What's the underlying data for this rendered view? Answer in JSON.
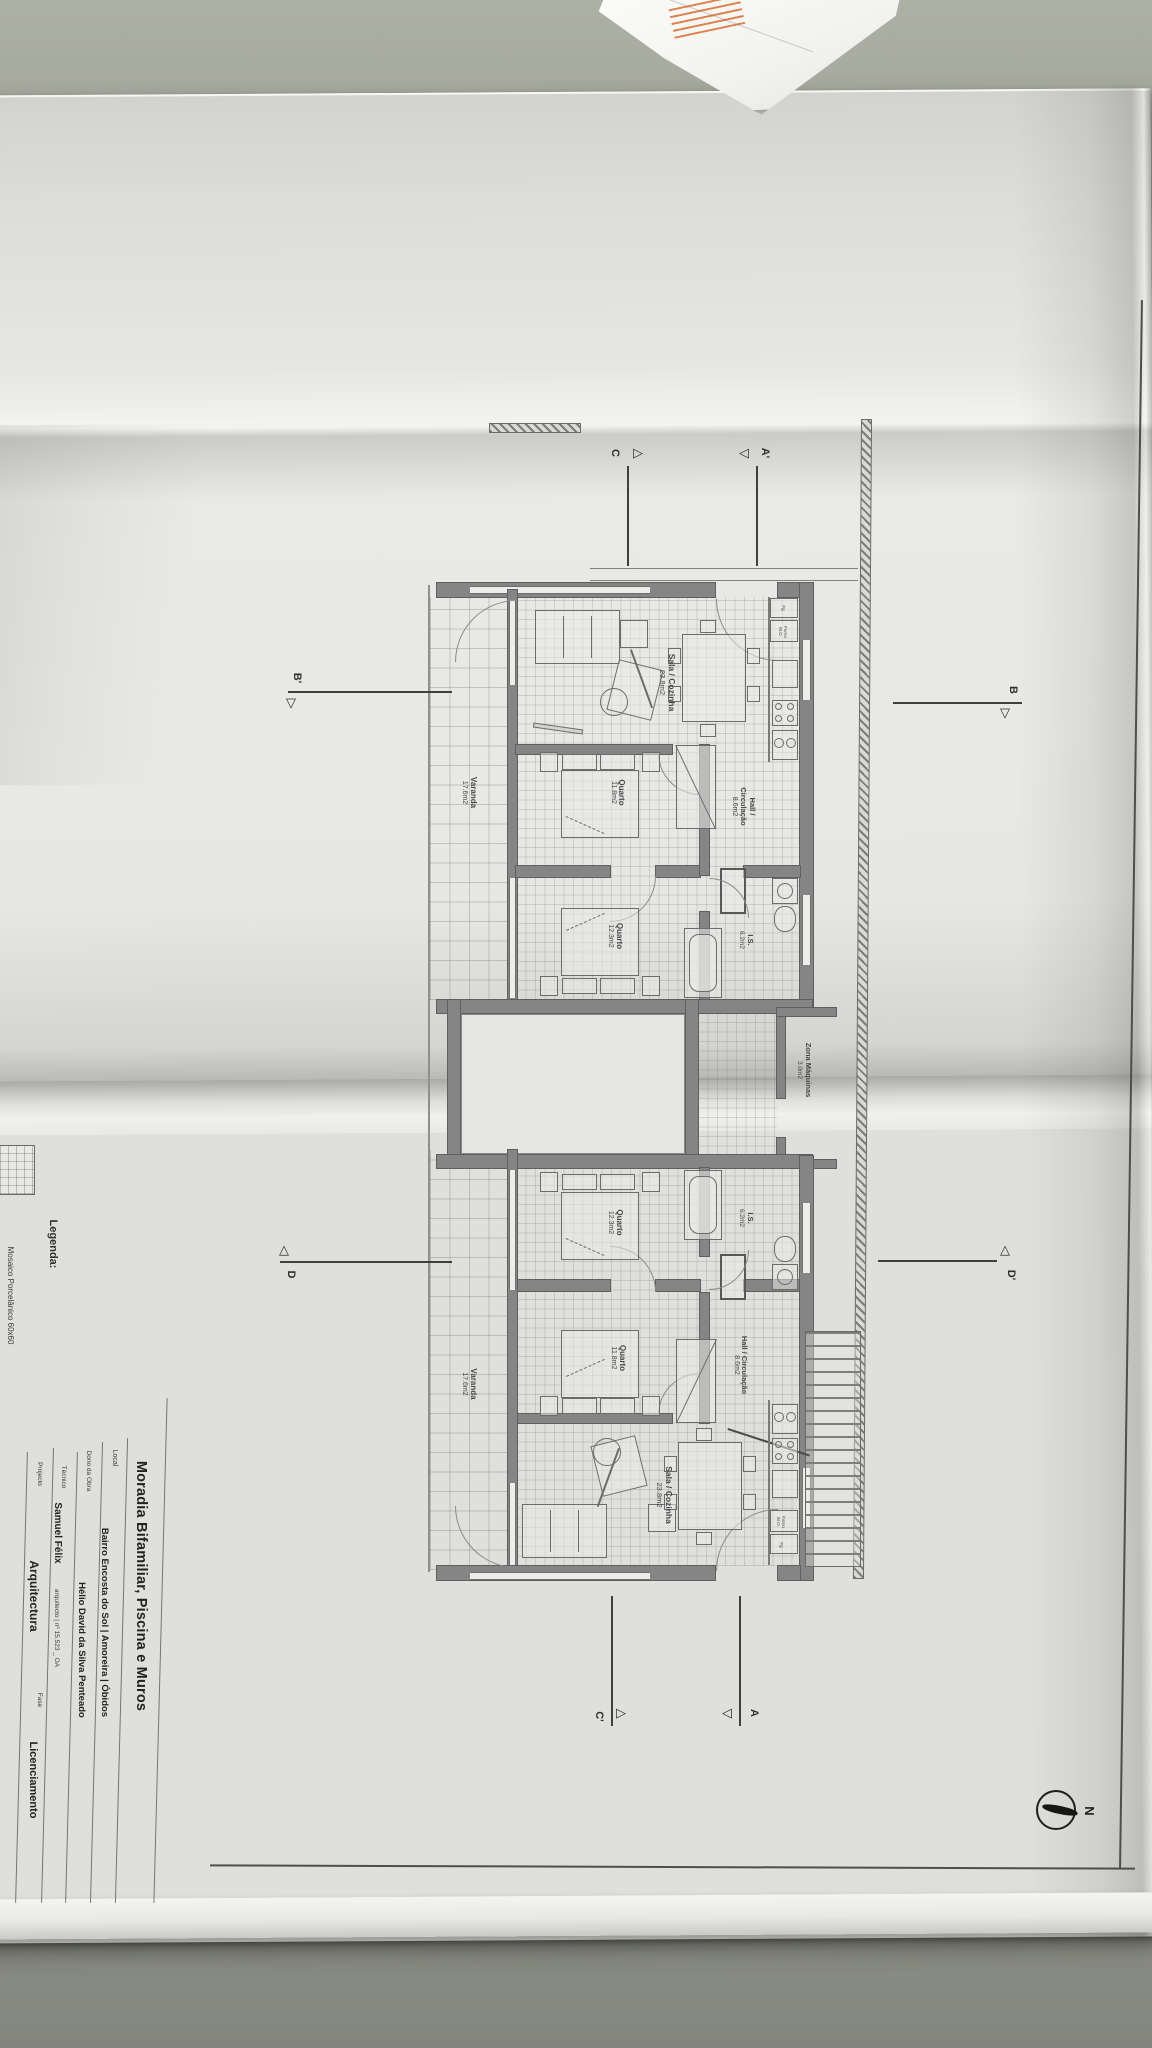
{
  "scene": {
    "kind": "photo of folded architectural floor plan sheet on a desk"
  },
  "icons": {
    "triangle_right": "▷",
    "triangle_left": "◁",
    "triangle_up": "△",
    "triangle_down": "▽"
  },
  "north": {
    "label": "N"
  },
  "legend": {
    "heading": "Legenda:",
    "item": "Mosaico Porcelânico 60x60"
  },
  "title_block": {
    "title": "Moradia Bifamiliar, Piscina e Muros",
    "local_label": "Local",
    "local_value": "Bairro Encosta do Sol | Amoreira | Óbidos",
    "owner_label": "Dono da Obra",
    "owner_value": "Hélio David da Silva Penteado",
    "technician_label": "Técnico",
    "technician_name": "Samuel Félix",
    "technician_suffix": "arquitecto | nº 15.523 _ OA",
    "project_label": "Projecto",
    "project_value": "Arquitectura",
    "phase_label": "Fase",
    "phase_value": "Licenciamento"
  },
  "markers": {
    "a": "A",
    "a_prime": "A'",
    "b": "B",
    "b_prime": "B'",
    "c": "C",
    "c_prime": "C'",
    "d": "D",
    "d_prime": "D'"
  },
  "rooms": {
    "upper_sala": {
      "name": "Sala / Cozinha",
      "area": "23.8m2"
    },
    "upper_hall": {
      "name": "Hall / Circulação",
      "area": "8.6m2"
    },
    "upper_quarto1": {
      "name": "Quarto",
      "area": "11.8m2"
    },
    "upper_quarto2": {
      "name": "Quarto",
      "area": "12.3m2"
    },
    "upper_is": {
      "name": "I.S.",
      "area": "6.2m2"
    },
    "upper_varanda": {
      "name": "Varanda",
      "area": "17.6m2"
    },
    "zona_maquinas": {
      "name": "Zona Máquinas",
      "area": "3.0m2"
    },
    "lower_quarto2": {
      "name": "Quarto",
      "area": "12.3m2"
    },
    "lower_is": {
      "name": "I.S.",
      "area": "6.2m2"
    },
    "lower_hall": {
      "name": "Hall / Circulação",
      "area": "8.6m2"
    },
    "lower_quarto1": {
      "name": "Quarto",
      "area": "11.8m2"
    },
    "lower_varanda": {
      "name": "Varanda",
      "area": "17.6m2"
    },
    "lower_sala": {
      "name": "Sala / Cozinha",
      "area": "23.8m2"
    }
  },
  "kitchen": {
    "oven": "Forno M.O.",
    "fridge": "Fg"
  }
}
